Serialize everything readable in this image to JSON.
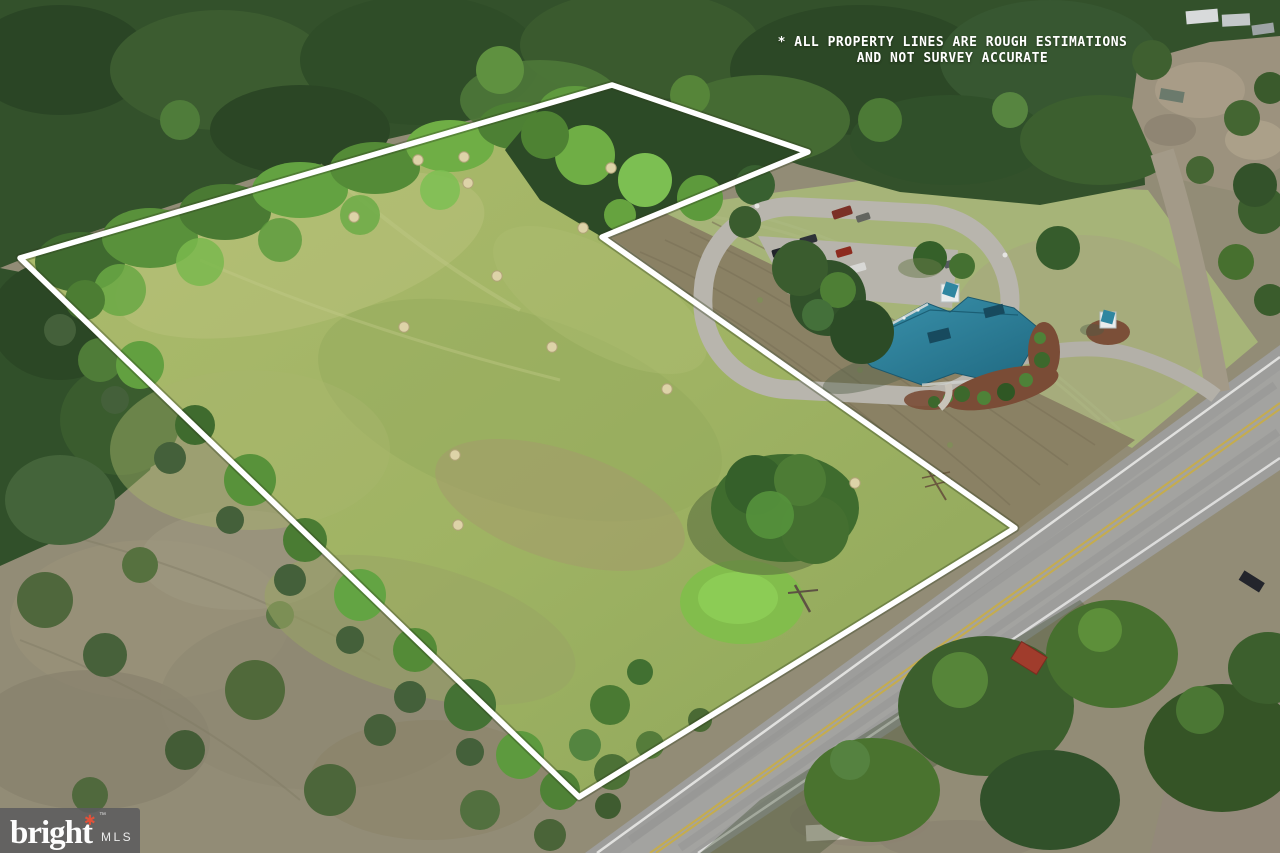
{
  "overlay": {
    "disclaimer": {
      "line1": "* ALL PROPERTY LINES ARE ROUGH ESTIMATIONS",
      "line2": "AND NOT SURVEY ACCURATE",
      "color": "#ffffff"
    },
    "watermark": {
      "brand": "bright",
      "star": "✱",
      "trademark": "™",
      "suffix": "MLS",
      "star_color": "#e0523a",
      "text_color": "#ffffff",
      "bar_color": "rgba(92,92,94,0.87)"
    }
  },
  "scene": {
    "type": "aerial-photo-of-land-parcel",
    "boundary": {
      "color": "#ffffff",
      "points": "20,258 612,85 808,152 602,237 1015,528 579,797",
      "stroke_width": 5.5
    },
    "hay_bales": [
      [
        418,
        160
      ],
      [
        464,
        157
      ],
      [
        468,
        183
      ],
      [
        611,
        168
      ],
      [
        354,
        217
      ],
      [
        583,
        228
      ],
      [
        497,
        276
      ],
      [
        404,
        327
      ],
      [
        552,
        347
      ],
      [
        455,
        455
      ],
      [
        458,
        525
      ],
      [
        855,
        483
      ],
      [
        667,
        389
      ]
    ],
    "palette": {
      "field": "#a3b766",
      "forest": "#33512b",
      "scrub": "#8f8a74",
      "tilled_dirt": "#8a8164",
      "road_asphalt": "#9d9d9b",
      "building_roof": "#2b7e99",
      "lawn": "#a6b478",
      "gravel": "#9c927e",
      "mulch": "#7a4c36"
    }
  }
}
